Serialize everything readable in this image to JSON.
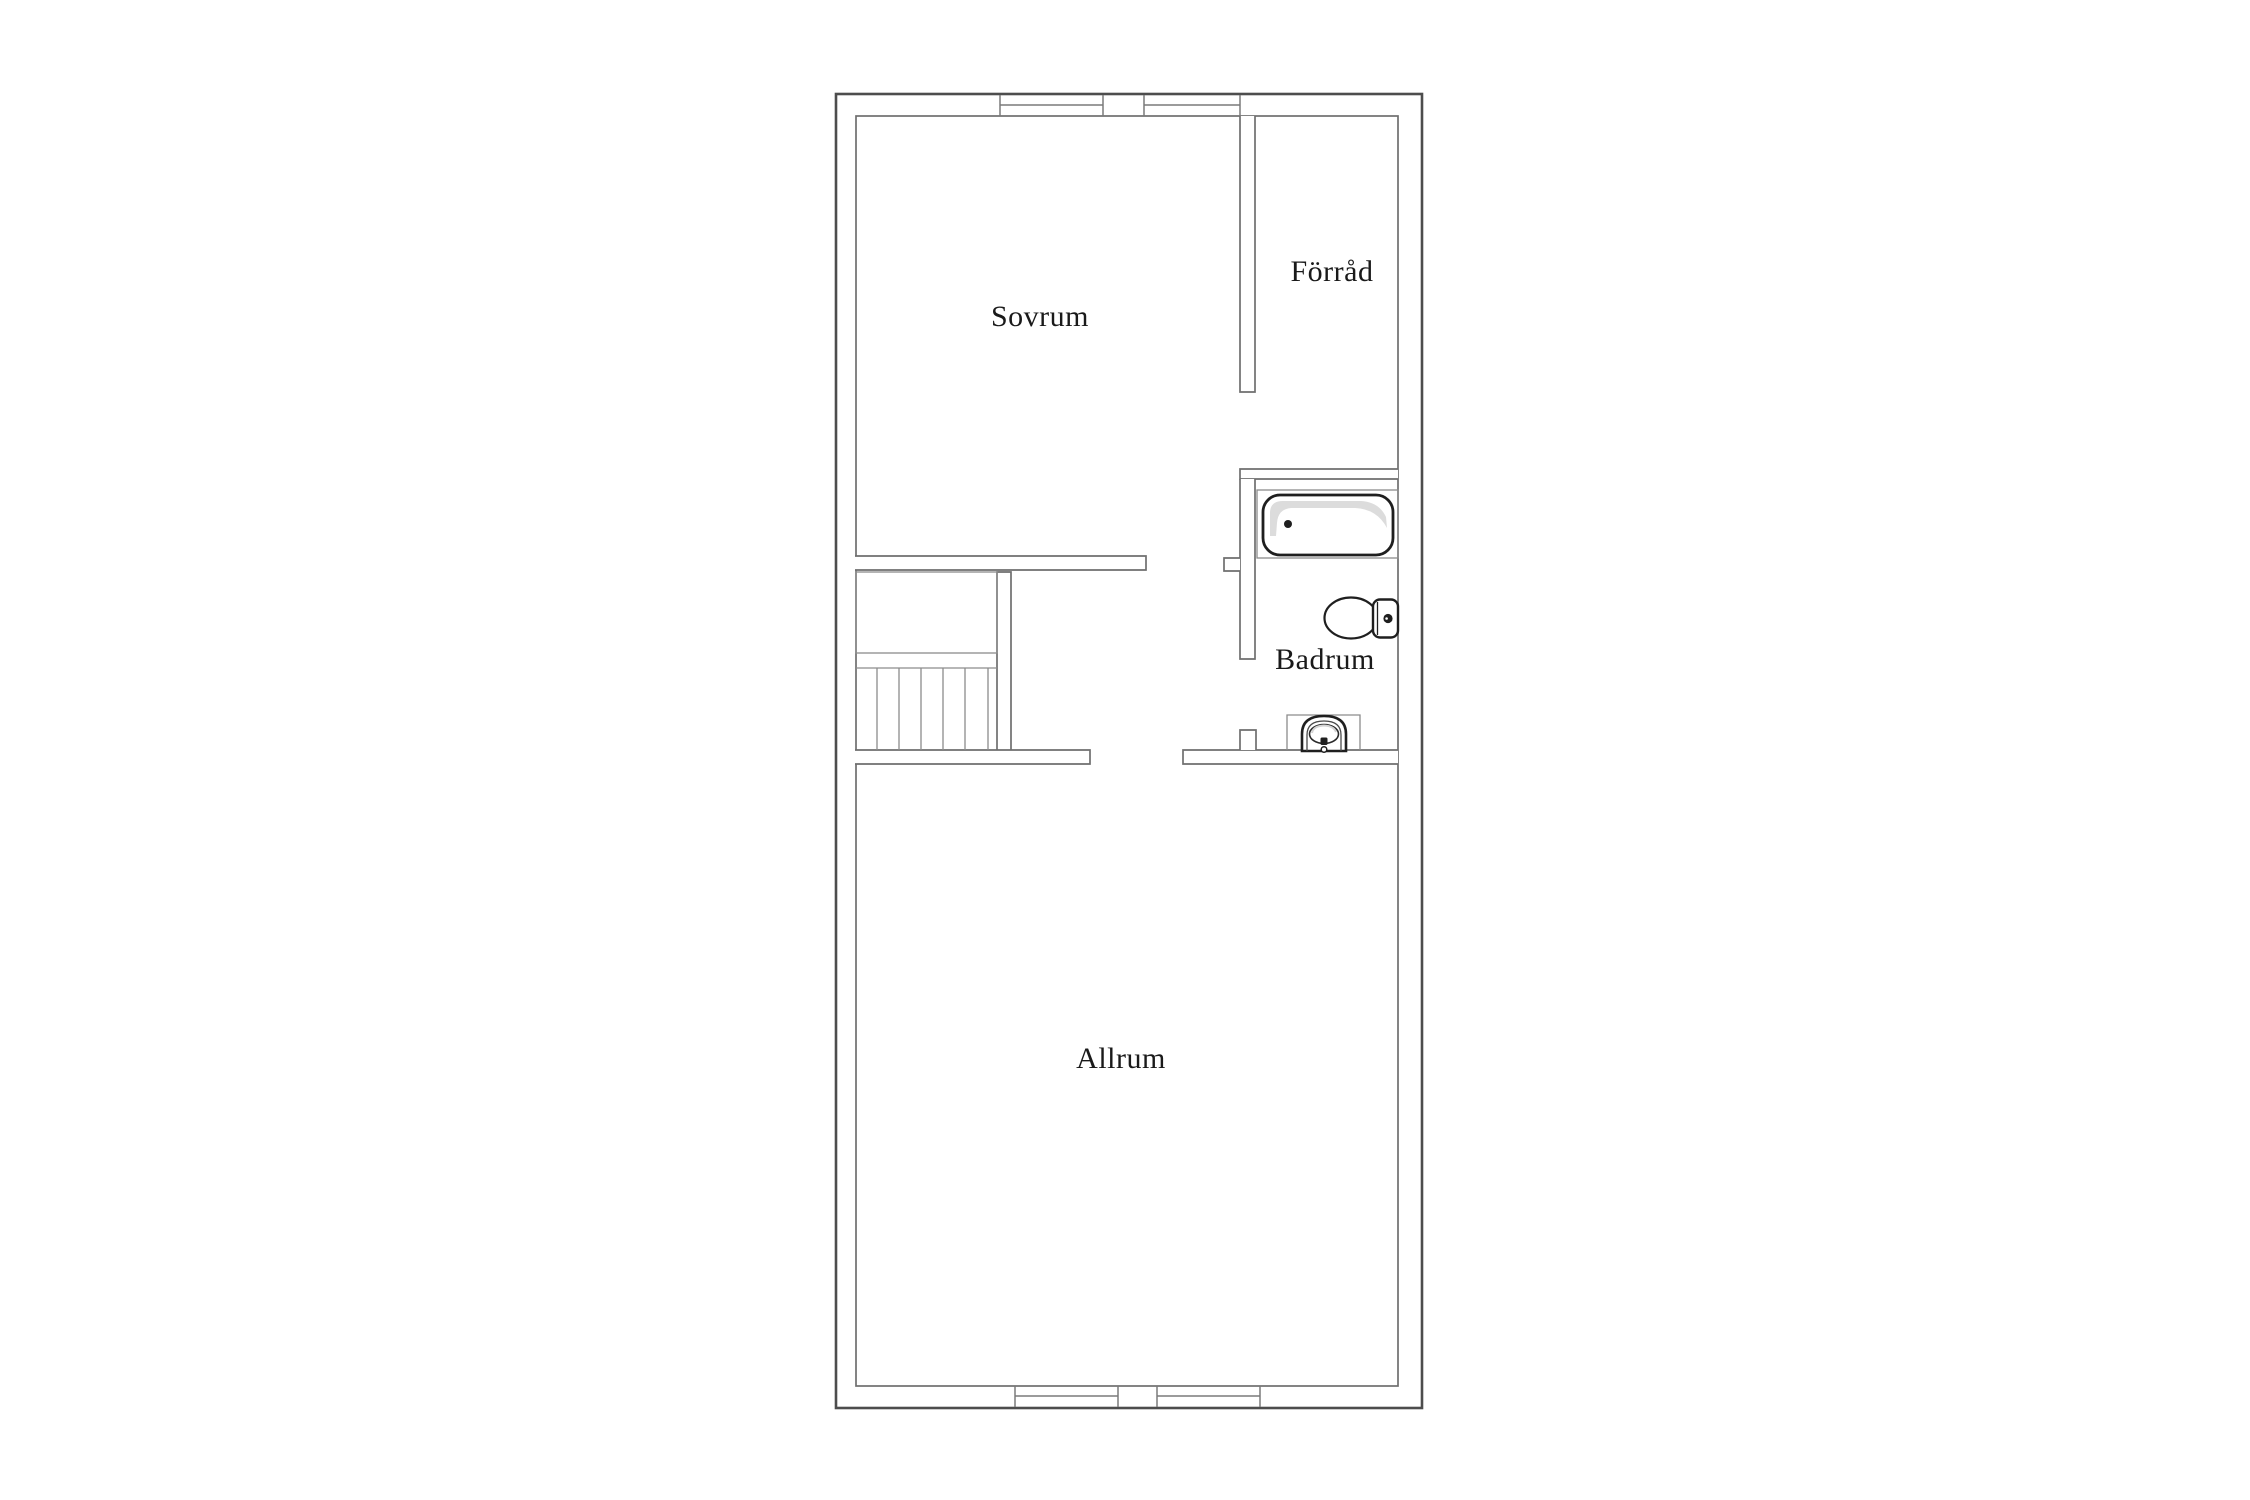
{
  "floorplan": {
    "type": "floor-plan",
    "language": "sv",
    "rooms": [
      {
        "id": "sovrum",
        "label": "Sovrum"
      },
      {
        "id": "forrad",
        "label": "Förråd"
      },
      {
        "id": "badrum",
        "label": "Badrum"
      },
      {
        "id": "allrum",
        "label": "Allrum"
      }
    ],
    "fixtures": [
      {
        "id": "bathtub",
        "icon": "bathtub-icon"
      },
      {
        "id": "toilet",
        "icon": "toilet-icon"
      },
      {
        "id": "sink",
        "icon": "sink-icon"
      },
      {
        "id": "staircase",
        "icon": "stairs-icon"
      },
      {
        "id": "closet",
        "icon": "closet-icon"
      }
    ],
    "window_count": {
      "top_wall": 2,
      "bottom_wall": 2
    },
    "colors": {
      "background": "#ffffff",
      "outer_wall": "#4d4d4d",
      "inner_wall": "#6f6f6f",
      "thin_line": "#8c8c8c",
      "fixture_line": "#1f1f1f",
      "shading": "#dcdcdc",
      "text": "#1a1a1a"
    }
  }
}
